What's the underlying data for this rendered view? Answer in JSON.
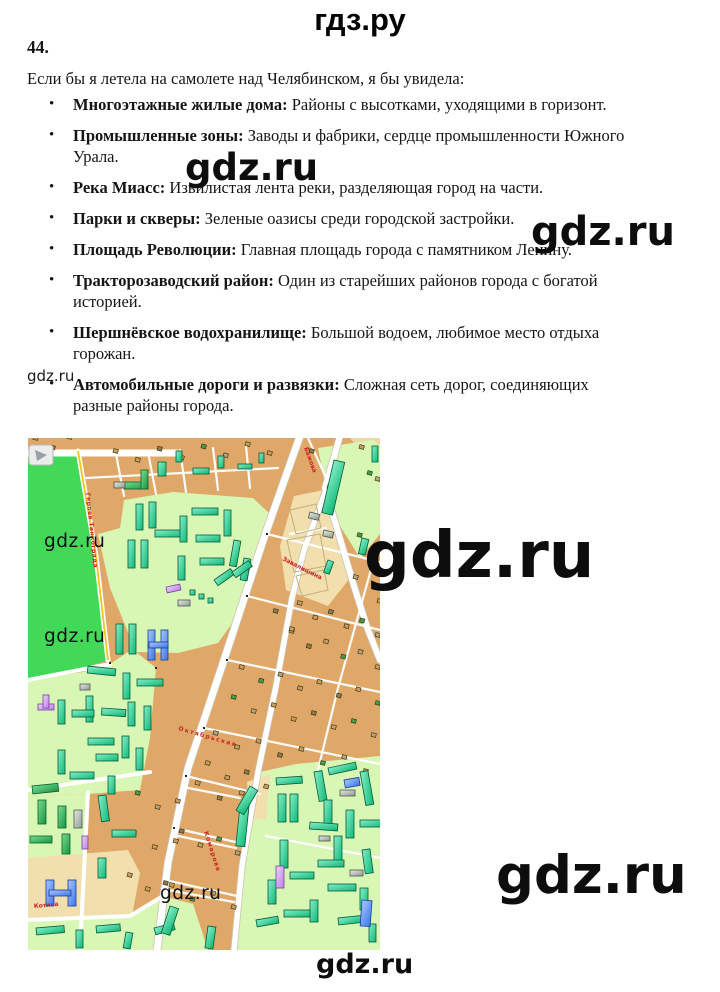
{
  "header": {
    "site": "гдз.ру"
  },
  "task": {
    "number": "44.",
    "intro": "Если бы я летела на самолете над Челябинском, я бы увидела:"
  },
  "list": {
    "items": [
      {
        "term": "Многоэтажные жилые дома:",
        "desc": "Районы с высотками, уходящими в горизонт."
      },
      {
        "term": "Промышленные зоны:",
        "desc": "Заводы и фабрики, сердце промышленности Южного Урала."
      },
      {
        "term": "Река Миасс:",
        "desc": "Извилистая лента реки, разделяющая город на части."
      },
      {
        "term": "Парки и скверы:",
        "desc": "Зеленые оазисы среди городской застройки."
      },
      {
        "term": "Площадь Революции:",
        "desc": "Главная площадь города с памятником Ленину."
      },
      {
        "term": "Тракторозаводский район:",
        "desc": "Один из старейших районов города с богатой историей."
      },
      {
        "term": "Шершнёвское водохранилище:",
        "desc": "Большой водоем, любимое место отдыха горожан."
      },
      {
        "term": "Автомобильные дороги и развязки:",
        "desc": "Сложная сеть дорог, соединяющих разные районы города."
      }
    ]
  },
  "watermark_text": "gdz.ru",
  "map": {
    "street_labels": {
      "bazhova": "Бажова",
      "zavalishina": "Завалишина",
      "oktyabrskaya": "Октябрьская",
      "komarova": "Комарова",
      "kotina": "Котина",
      "geroev": "Героев Танкограда"
    },
    "colors": {
      "park": "#41d957",
      "residential": "#d8f6b4",
      "blocks": "#e0a868",
      "open_area": "#f1dfae",
      "road": "#ffffff",
      "road_accent": "#f5c518",
      "building_teal": "#10b97a",
      "building_blue": "#3c76e8",
      "building_purple": "#c183e8",
      "building_gray": "#96a09a",
      "building_darkgreen": "#1c9b40",
      "street_label": "#cc2222"
    }
  }
}
